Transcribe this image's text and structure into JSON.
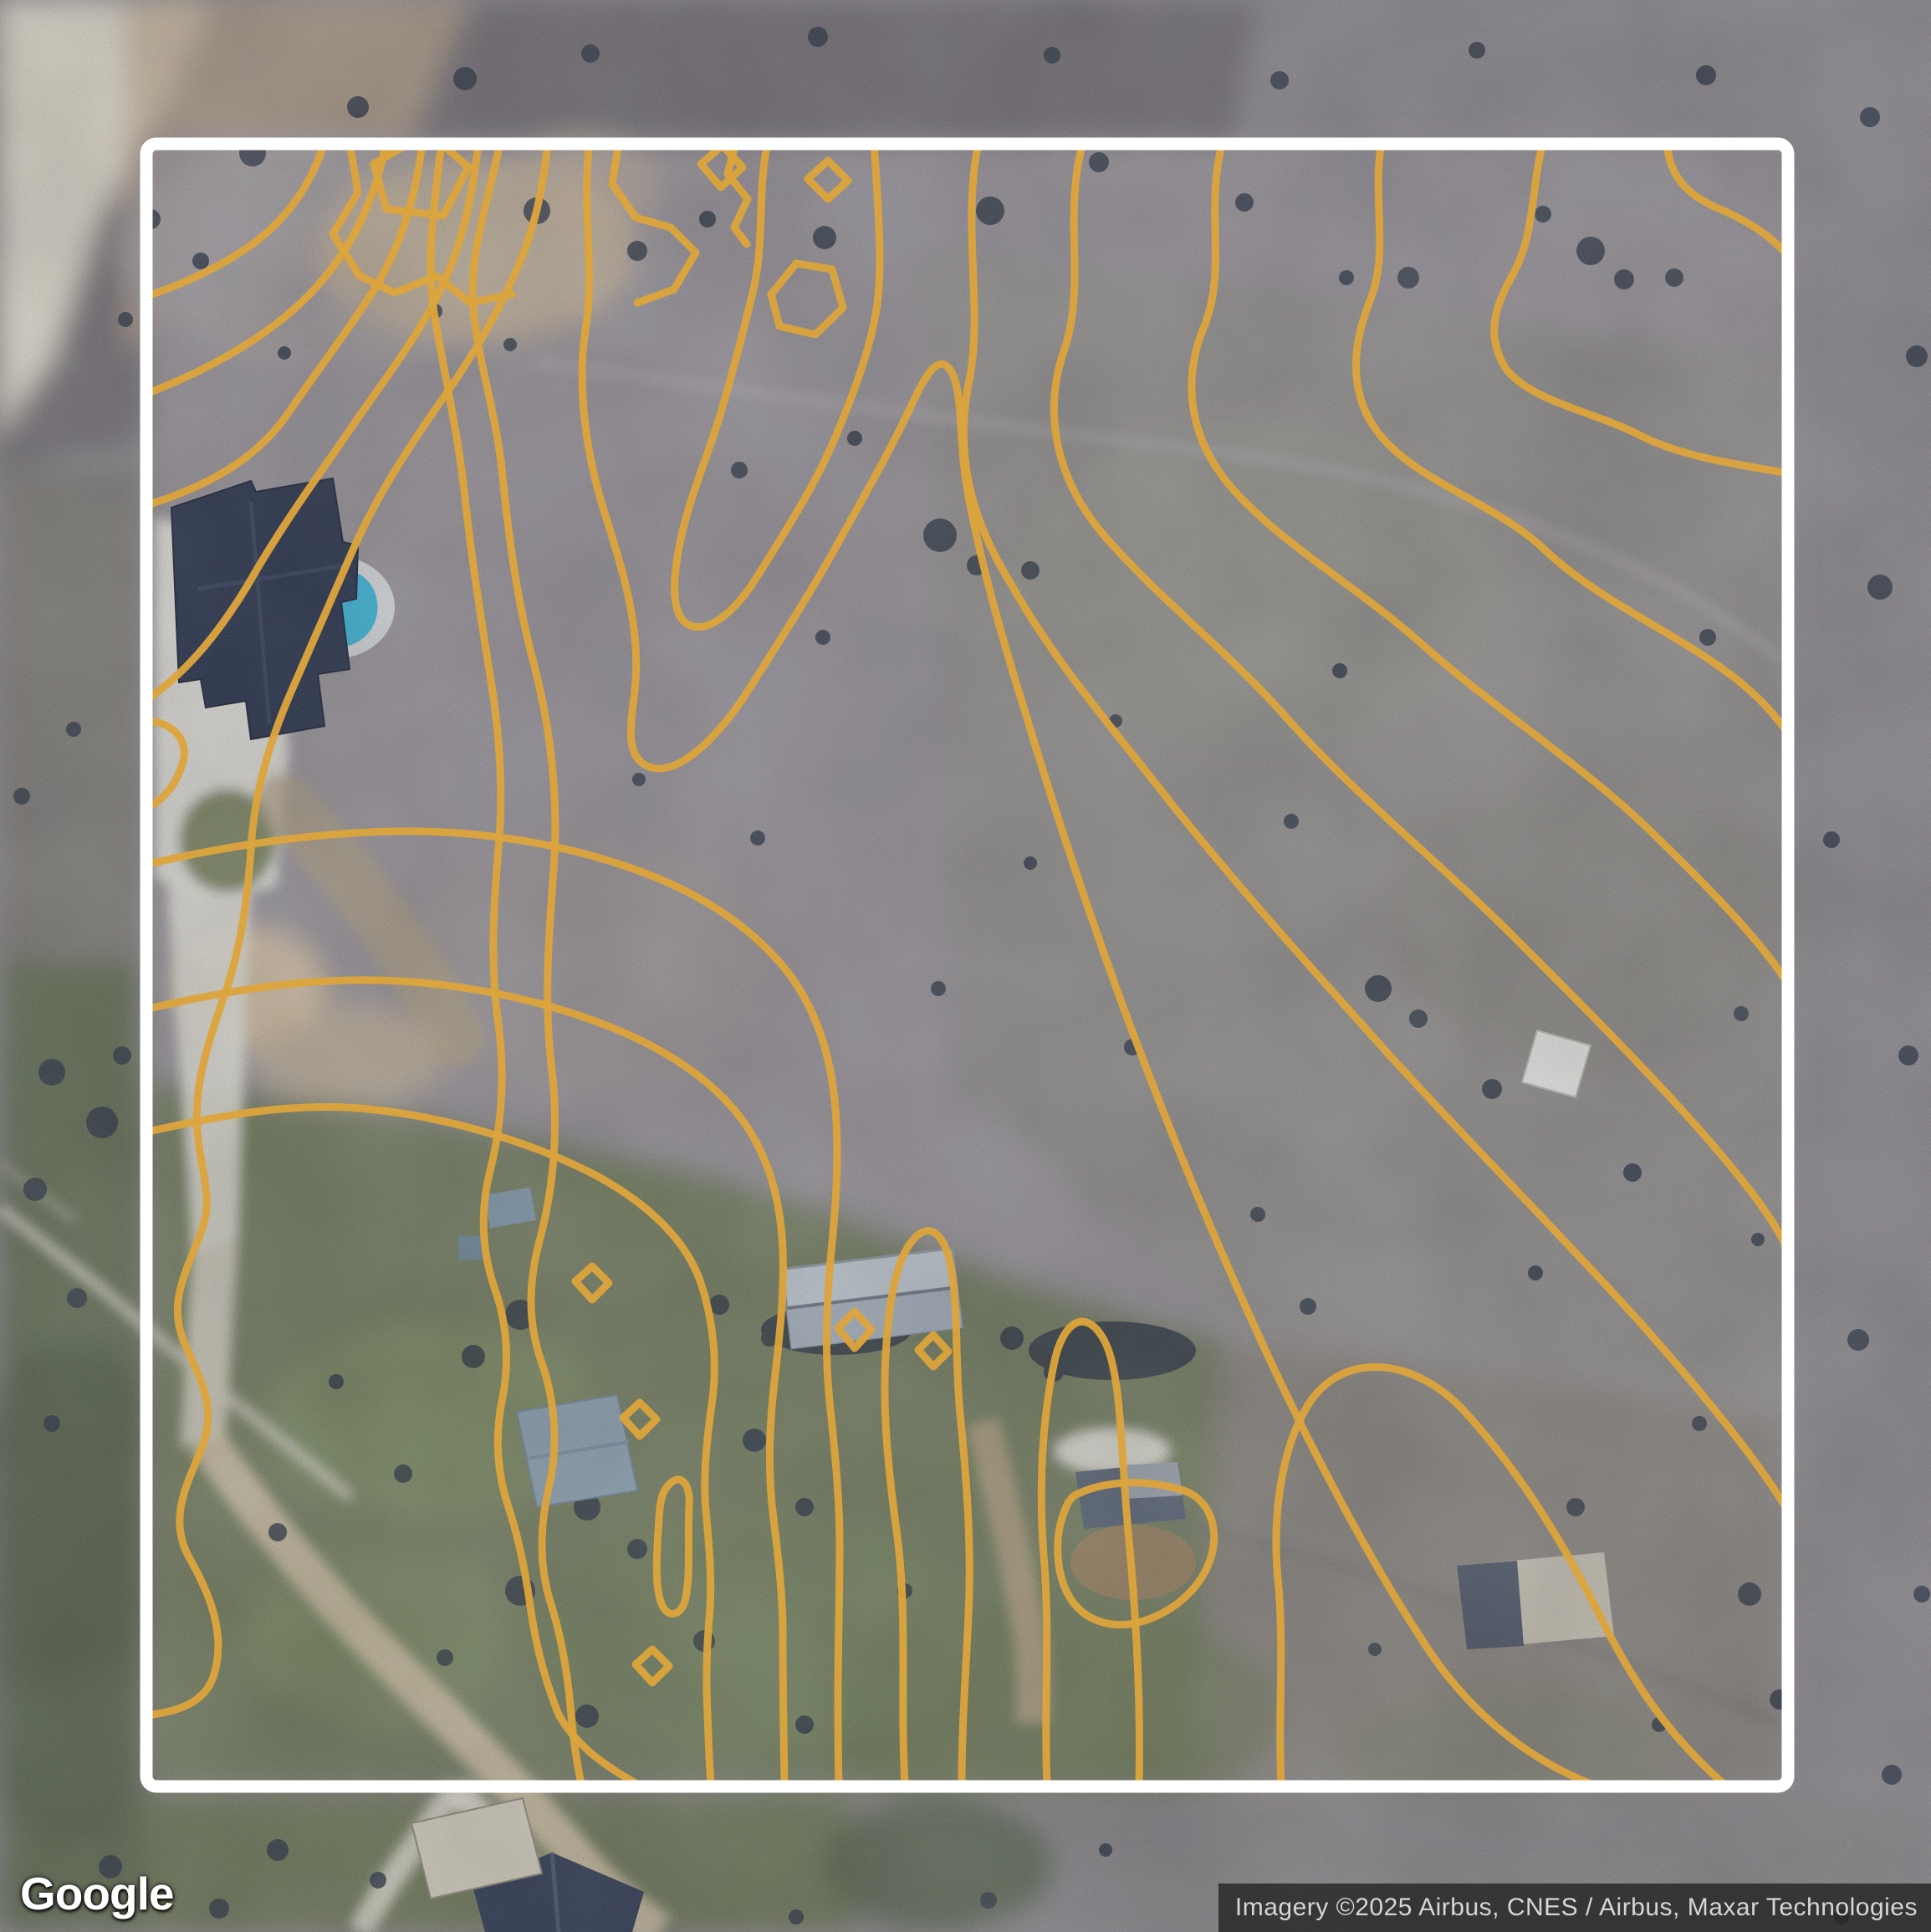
{
  "map": {
    "logo": "Google",
    "attribution": "Imagery ©2025 Airbus, CNES / Airbus, Maxar Technologies"
  },
  "colors": {
    "contour": "#DCA43C",
    "boundary": "#FFFFFF",
    "pool": "#35B6DC",
    "attribution_bg": "rgba(35,35,35,0.8)",
    "attribution_fg": "#D6D6D6"
  }
}
